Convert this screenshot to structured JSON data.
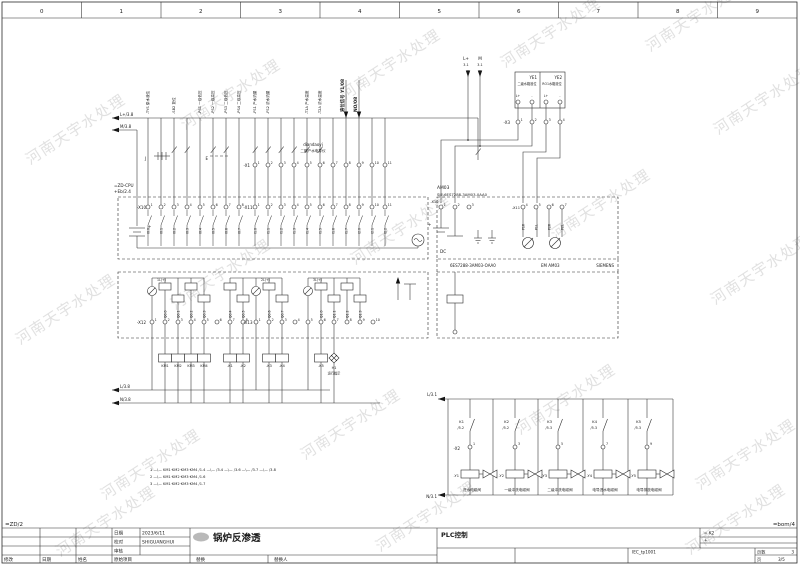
{
  "page": {
    "watermark": "河南天宇水处理",
    "columns": [
      "0",
      "1",
      "2",
      "3",
      "4",
      "5",
      "6",
      "7",
      "8",
      "9"
    ]
  },
  "top": {
    "bus_l": "L+/3.8",
    "bus_m": "M/3.8",
    "j": "J",
    "e": "E",
    "vlabels": [
      "-TYS 原水液位",
      "-SB2 复位",
      "-PS1 一级低压",
      "-PS2 一级高压",
      "-PS3 二级低压",
      "-PS4 二级高压",
      "-FS1 产水流量",
      "-FS2 浓水流量",
      "-T1A 产水温度",
      "-T2A 浓水温度"
    ],
    "bold1": "液位信号 Y1/08",
    "bold2": "NO/08",
    "dian1": "diandaoyi",
    "dian2": "二期产水电导仪",
    "x1_tag": "-X1",
    "x1_nums": [
      "1",
      "2",
      "3",
      "4",
      "5",
      "6",
      "7",
      "8",
      "9",
      "10",
      "11"
    ]
  },
  "inst": {
    "l": "L+",
    "l_ref": "3.1",
    "m": "M",
    "m_ref": "3.1",
    "ye1": "YE1",
    "ye1_desc": "二级水箱液位",
    "ye2": "YE2",
    "ye2_desc": "RO1水箱液位",
    "tp": "L+",
    "tm": "-",
    "x3_tag": "-X3",
    "x3_nums": [
      "1",
      "2",
      "3",
      "4"
    ]
  },
  "cpu": {
    "ref": "=ZD-CPU",
    "loc": "+Eb/2.4",
    "plus": "+",
    "x10_tag": "-X10",
    "x10_nums": [
      "1",
      "2",
      "3",
      "4",
      "5",
      "6",
      "7",
      "8"
    ],
    "x11_tag": "-X11",
    "x11_nums": [
      "1",
      "2",
      "3",
      "4",
      "5",
      "6",
      "7",
      "8",
      "9",
      "10",
      "11"
    ],
    "sig1": [
      "I0.0",
      "I0.1",
      "I0.2",
      "I0.3",
      "I0.4",
      "I0.5",
      "I0.6",
      "I0.7"
    ],
    "sig2": [
      "I1.0",
      "I1.1",
      "I1.2",
      "I1.3",
      "I1.4",
      "I1.5",
      "I1.6",
      "I1.7",
      "I2.0",
      "I2.1",
      "I2.2"
    ]
  },
  "am03": {
    "name": "AM03",
    "part": "SIE.6ES7288-3AM03-0AA0",
    "x10_tag": "-X10",
    "nums1": [
      "1",
      "2",
      "3"
    ],
    "x11_tag": "-X11",
    "nums2": [
      "4",
      "5",
      "6",
      "7"
    ],
    "sigs": [
      "P1R",
      "P1L",
      "P2R",
      "P2L"
    ],
    "dc": "DC",
    "plus": "+",
    "cap1": "6ES7288-3AM03-OAA0",
    "cap2": "EM AM03",
    "cap3": "SIEMENS"
  },
  "out": {
    "x12_tag": "-X12",
    "x12_nums": [
      "1",
      "2",
      "3",
      "4",
      "5",
      "6",
      "7",
      "8"
    ],
    "x13_tag": "-X13",
    "x13_nums": [
      "1",
      "2",
      "3",
      "4",
      "5",
      "6",
      "7",
      "8",
      "9",
      "10"
    ],
    "q": [
      "Q0.0",
      "Q0.1",
      "Q0.2",
      "Q0.3",
      "Q0.4",
      "Q0.5",
      "Q0.6",
      "Q0.7",
      "Q1.0",
      "Q1.1",
      "Q1.2",
      "Q1.3"
    ],
    "c1": "1L(+)",
    "c2": "2L(+)",
    "c3": "3L(+)"
  },
  "coils": {
    "km": [
      "KM1",
      "KM2",
      "KM3",
      "KM4"
    ],
    "k12": [
      "-K1",
      "-K2"
    ],
    "k34": [
      "-K3",
      "-K4"
    ],
    "k5": [
      "-K5"
    ],
    "h1": "H1",
    "h1_desc": "运行指示"
  },
  "buses": {
    "bl_l": "L/3.8",
    "bl_n": "N/3.8",
    "br_l": "L/3.1",
    "br_n": "N/3.1"
  },
  "valves": {
    "x2": "-X2",
    "items": [
      {
        "k": "K1",
        "ref": "/5.2",
        "num": "1",
        "tag": "-Y1",
        "desc": "进水电磁阀"
      },
      {
        "k": "K2",
        "ref": "/5.2",
        "num": "3",
        "tag": "-Y2",
        "desc": "一级冲洗电磁阀"
      },
      {
        "k": "K3",
        "ref": "/5.3",
        "num": "5",
        "tag": "-Y3",
        "desc": "二级冲洗电磁阀"
      },
      {
        "k": "K4",
        "ref": "/5.3",
        "num": "7",
        "tag": "-Y4",
        "desc": "电导进水电磁阀"
      },
      {
        "k": "K5",
        "ref": "/5.3",
        "num": "9",
        "tag": "-Y5",
        "desc": "电导排放电磁阀"
      }
    ]
  },
  "notes": [
    "1 —\\— KM1·KM2·KM3·KM4 /1.4    —\\— /3.4    —\\— /3.6    —\\— /3.7    —\\— /3.8",
    "2 —\\— KM1·KM2·KM3·KM4 /1.6",
    "3 —\\— KM1·KM2·KM3·KM4 /1.7"
  ],
  "titleblock": {
    "zd": "=ZD/2",
    "bom": "=bom/4",
    "date_label": "日期",
    "date": "2023/6/11",
    "check_label": "校对",
    "check": "SHIGUANGHUI",
    "audit_label": "审核",
    "modify": "修改",
    "date2": "日期",
    "name": "姓名",
    "orig": "原始项目",
    "replace": "替换",
    "replace_by": "替换人",
    "title": "锅炉反渗透",
    "subtitle": "PLC控制",
    "k2": "= K2",
    "plus": "+",
    "iec": "IEC_tp1001",
    "pages_label": "页数",
    "pages": "3",
    "page_label": "页",
    "page": "3/5"
  }
}
